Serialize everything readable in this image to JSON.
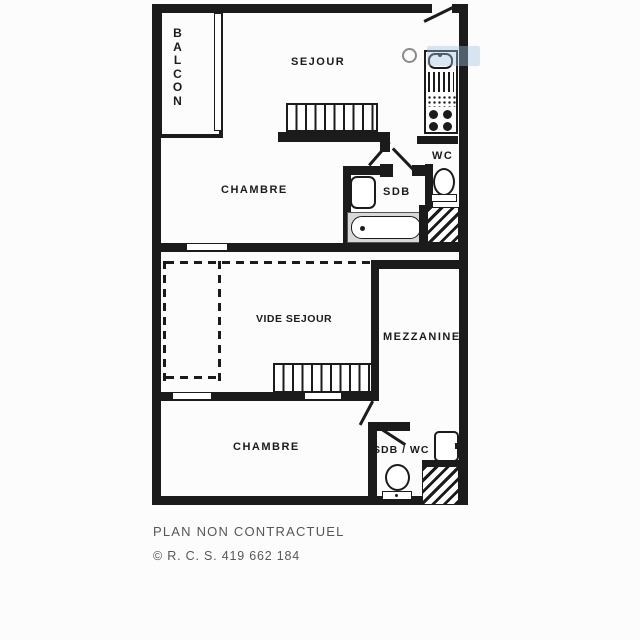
{
  "document_type": "apartment floor plan (two levels)",
  "colors": {
    "ink": "#1b1b1b",
    "paper": "#fcfcfc",
    "footer_ink": "#54585b",
    "wm_blue": "#9fc0e2",
    "ring_gray": "#8a8a8a"
  },
  "plan": {
    "upper": {
      "labels": {
        "balcon": "BALCON",
        "sejour": "SEJOUR",
        "chambre": "CHAMBRE",
        "sdb": "SDB",
        "wc": "WC"
      },
      "fixtures": [
        "balcony-window",
        "entrance-door-swing",
        "staircase",
        "kitchen-sink",
        "kitchen-hob",
        "bathtub",
        "washbasin",
        "toilet",
        "duct-hatch",
        "window"
      ]
    },
    "lower": {
      "labels": {
        "vide_sejour": "VIDE SEJOUR",
        "mezzanine": "MEZZANINE",
        "chambre": "CHAMBRE",
        "sdb_wc": "SDB / WC"
      },
      "fixtures": [
        "void-dashed-outline",
        "staircase",
        "windows",
        "door-swing",
        "washbasin",
        "toilet",
        "duct-hatch"
      ]
    }
  },
  "footer": {
    "disclaimer": "PLAN NON CONTRACTUEL",
    "copyright": "© R. C. S. 419 662 184"
  }
}
